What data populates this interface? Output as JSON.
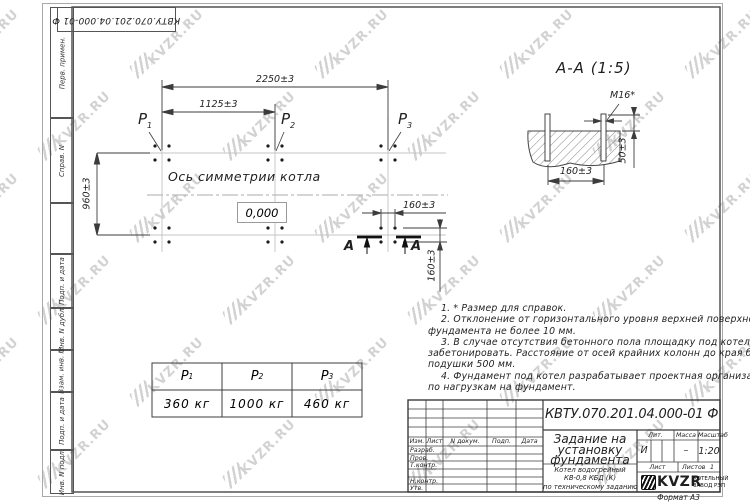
{
  "watermark": {
    "text": "KVZR.RU"
  },
  "stamps": {
    "top_code": "КВТУ.070.201.04.000-01 Ф",
    "margin": [
      "Перв. примен.",
      "Справ. N",
      "",
      "Подп. и дата",
      "Инв. N дубл.",
      "Взам. инв. N",
      "Подп. и дата",
      "Инв. N подл."
    ]
  },
  "plan": {
    "p_labels": [
      {
        "base": "P",
        "sub": "1"
      },
      {
        "base": "P",
        "sub": "2"
      },
      {
        "base": "P",
        "sub": "3"
      }
    ],
    "dims": {
      "d2250": "2250±3",
      "d1125": "1125±3",
      "d960": "960±3",
      "d160h": "160±3",
      "d160v": "160±3"
    },
    "axis_label": "Ось симметрии котла",
    "level_mark": "0,000",
    "section_letter_left": "А",
    "section_letter_right": "А"
  },
  "section": {
    "title": "А-А (1:5)",
    "dims": {
      "m16": "М16*",
      "d50": "50±3",
      "d160": "160±3"
    }
  },
  "load_table": {
    "headers": [
      {
        "base": "P",
        "sub": "1"
      },
      {
        "base": "P",
        "sub": "2"
      },
      {
        "base": "P",
        "sub": "3"
      }
    ],
    "values": [
      "360 кг",
      "1000 кг",
      "460 кг"
    ]
  },
  "notes": {
    "lines": [
      "1. * Размер для справок.",
      "2. Отклонение от горизонтального уровня верхней поверхности",
      "фундамента не более 10 мм.",
      "3. В случае отсутствия бетонного пола площадку под котел",
      "забетонировать. Расстояние от осей крайних колонн до края бетонной",
      "подушки 500 мм.",
      "4. Фундамент под котел разрабатывает проектная организация",
      "по нагрузкам на фундамент."
    ]
  },
  "title_block": {
    "doc_code": "КВТУ.070.201.04.000-01 Ф",
    "title_lines": [
      "Задание на",
      "установку",
      "фундамента"
    ],
    "subtitle_lines": [
      "Котел водогрейный",
      "КВ-0,8 КБД (К)",
      "по техническому заданию"
    ],
    "header_cols": [
      "Изм.",
      "Лист",
      "N докум.",
      "Подп.",
      "Дата"
    ],
    "rows": [
      "Разраб.",
      "Пров.",
      "Т.контр.",
      "",
      "Н.контр.",
      "Утв."
    ],
    "lit_header": "Лит.",
    "mass_header": "Масса",
    "scale_header": "Масштаб",
    "lit_value": "И",
    "mass_value": "–",
    "scale_value": "1:20",
    "sheet_label": "Лист",
    "sheets_label": "Листов",
    "sheets_value": "1",
    "logo_text": "KVZR",
    "logo_caption_lines": [
      "КОТЕЛЬНЫЙ",
      "ЗАВОД РЭП"
    ],
    "format_label": "Формат А3"
  }
}
